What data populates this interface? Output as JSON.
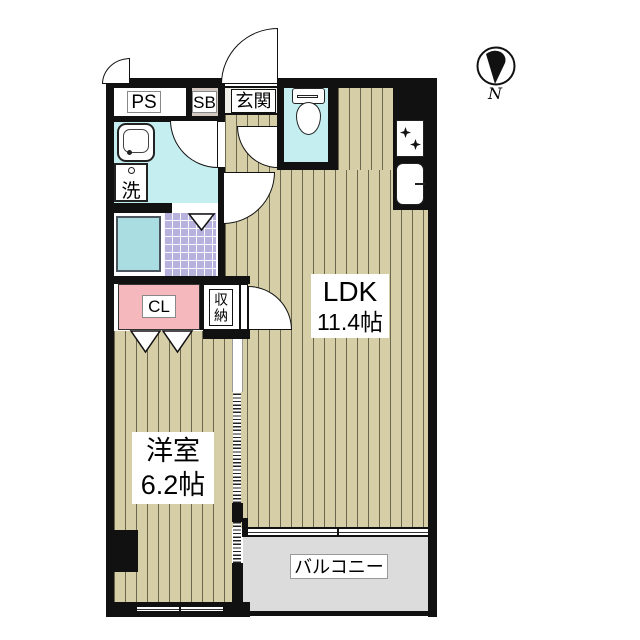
{
  "page": {
    "type": "apartment-floor-plan",
    "compass_label": "N"
  },
  "labels": {
    "ps": "PS",
    "sb": "SB",
    "entrance": "玄関",
    "laundry": "洗",
    "closet": "CL",
    "storage": "収納",
    "ldk_name": "LDK",
    "ldk_size": "11.4帖",
    "western_name": "洋室",
    "western_size": "6.2帖",
    "balcony": "バルコニー"
  },
  "rooms": [
    {
      "name": "LDK",
      "size_jo": 11.4
    },
    {
      "name": "洋室",
      "size_jo": 6.2
    },
    {
      "name": "玄関"
    },
    {
      "name": "PS"
    },
    {
      "name": "SB"
    },
    {
      "name": "洗面・洗濯"
    },
    {
      "name": "浴室"
    },
    {
      "name": "トイレ"
    },
    {
      "name": "CL"
    },
    {
      "name": "収納"
    },
    {
      "name": "バルコニー"
    }
  ],
  "icons": {
    "compass": "compass-north-icon",
    "toilet": "toilet-icon",
    "vanity": "washbasin-icon",
    "laundry": "washing-machine-icon",
    "bathtub": "bathtub-icon",
    "stove": "stove-burners-icon",
    "kitchen_sink": "kitchen-sink-icon"
  },
  "colors": {
    "wall": "#111111",
    "tatami": "#d6cea7",
    "tatami_stripe": "#32301e",
    "water_room": "#c5eef1",
    "bathtub": "#a9dde2",
    "bath_tile": "#b7b1de",
    "closet_pink": "#f5b9bd",
    "sb_beige": "#d2c9c0",
    "entrance_floor": "#efede8",
    "balcony_gray": "#dcdcdc"
  }
}
